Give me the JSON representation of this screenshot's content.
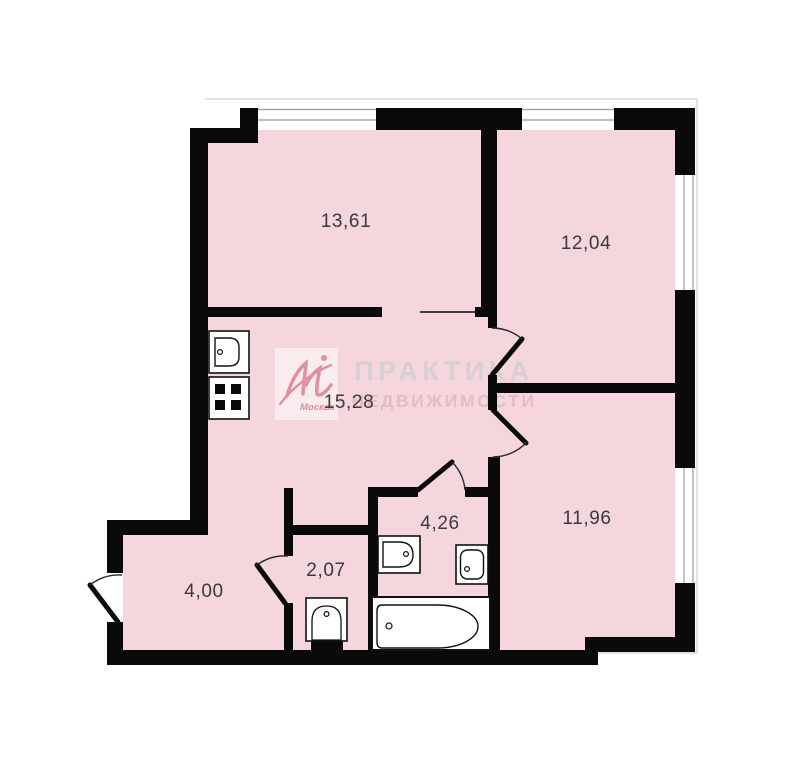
{
  "floorplan": {
    "rooms": [
      {
        "name": "room-13-61",
        "area_label": "13,61"
      },
      {
        "name": "room-12-04",
        "area_label": "12,04"
      },
      {
        "name": "room-15-28",
        "area_label": "15,28"
      },
      {
        "name": "room-11-96",
        "area_label": "11,96"
      },
      {
        "name": "room-4-26",
        "area_label": "4,26"
      },
      {
        "name": "room-2-07",
        "area_label": "2,07"
      },
      {
        "name": "room-4-00",
        "area_label": "4,00"
      }
    ],
    "watermark": {
      "line1": "ПРАКТИКА",
      "line2": "НЕДВИЖИМОСТИ",
      "logo_text": "Москва"
    },
    "colors": {
      "room_fill": "#f4d6dc",
      "wall": "#0a0a0a",
      "label_text": "#3b393b",
      "watermark_line1": "#d6d0d1",
      "watermark_line2": "#e0bcc4",
      "logo_accent": "#dc8193",
      "window_line": "#9b9b9b"
    }
  }
}
